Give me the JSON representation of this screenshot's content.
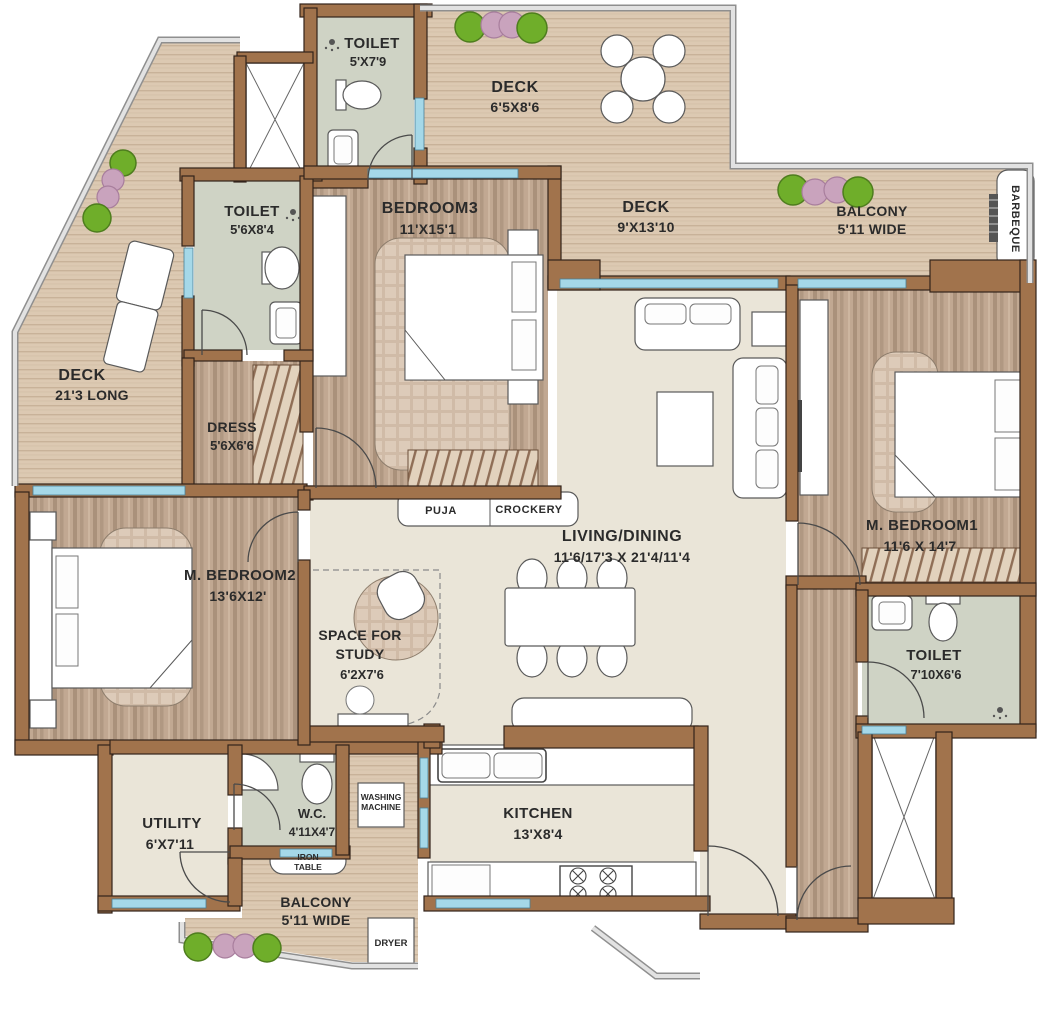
{
  "title": "Apartment Floor Plan",
  "colors": {
    "wall": "#a1734c",
    "deck_floor": "#dcc9b2",
    "bedroom_floor": "#c1a892",
    "living_floor": "#eae5d8",
    "toilet_floor": "#cfd3c5",
    "window": "#a5d8e8",
    "label": "#2b2b2b",
    "bush_green": "#6fae2a",
    "bush_pink": "#c9a3bd"
  },
  "rooms": {
    "toilet_top": {
      "name": "TOILET",
      "size": "5'X7'9"
    },
    "deck_top": {
      "name": "DECK",
      "size": "6'5X8'6"
    },
    "deck_right": {
      "name": "DECK",
      "size": "9'X13'10"
    },
    "balcony_top": {
      "name": "BALCONY",
      "size": "5'11 WIDE"
    },
    "barbeque": {
      "name": "BARBEQUE"
    },
    "toilet_left": {
      "name": "TOILET",
      "size": "5'6X8'4"
    },
    "deck_left": {
      "name": "DECK",
      "size": "21'3 LONG"
    },
    "dress": {
      "name": "DRESS",
      "size": "5'6X6'6"
    },
    "bedroom3": {
      "name": "BEDROOM3",
      "size": "11'X15'1"
    },
    "puja": {
      "name": "PUJA"
    },
    "crockery": {
      "name": "CROCKERY"
    },
    "living_dining": {
      "name": "LIVING/DINING",
      "size": "11'6/17'3 X 21'4/11'4"
    },
    "m_bedroom1": {
      "name": "M. BEDROOM1",
      "size": "11'6 X 14'7"
    },
    "toilet_m1": {
      "name": "TOILET",
      "size": "7'10X6'6"
    },
    "m_bedroom2": {
      "name": "M. BEDROOM2",
      "size": "13'6X12'"
    },
    "study": {
      "line1": "SPACE FOR",
      "line2": "STUDY",
      "size": "6'2X7'6"
    },
    "utility": {
      "name": "UTILITY",
      "size": "6'X7'11"
    },
    "wc": {
      "name": "W.C.",
      "size": "4'11X4'7"
    },
    "washing_machine": {
      "line1": "WASHING",
      "line2": "MACHINE"
    },
    "iron_table": {
      "line1": "IRON",
      "line2": "TABLE"
    },
    "kitchen": {
      "name": "KITCHEN",
      "size": "13'X8'4"
    },
    "balcony_bottom": {
      "name": "BALCONY",
      "size": "5'11 WIDE"
    },
    "dryer": {
      "name": "DRYER"
    }
  }
}
